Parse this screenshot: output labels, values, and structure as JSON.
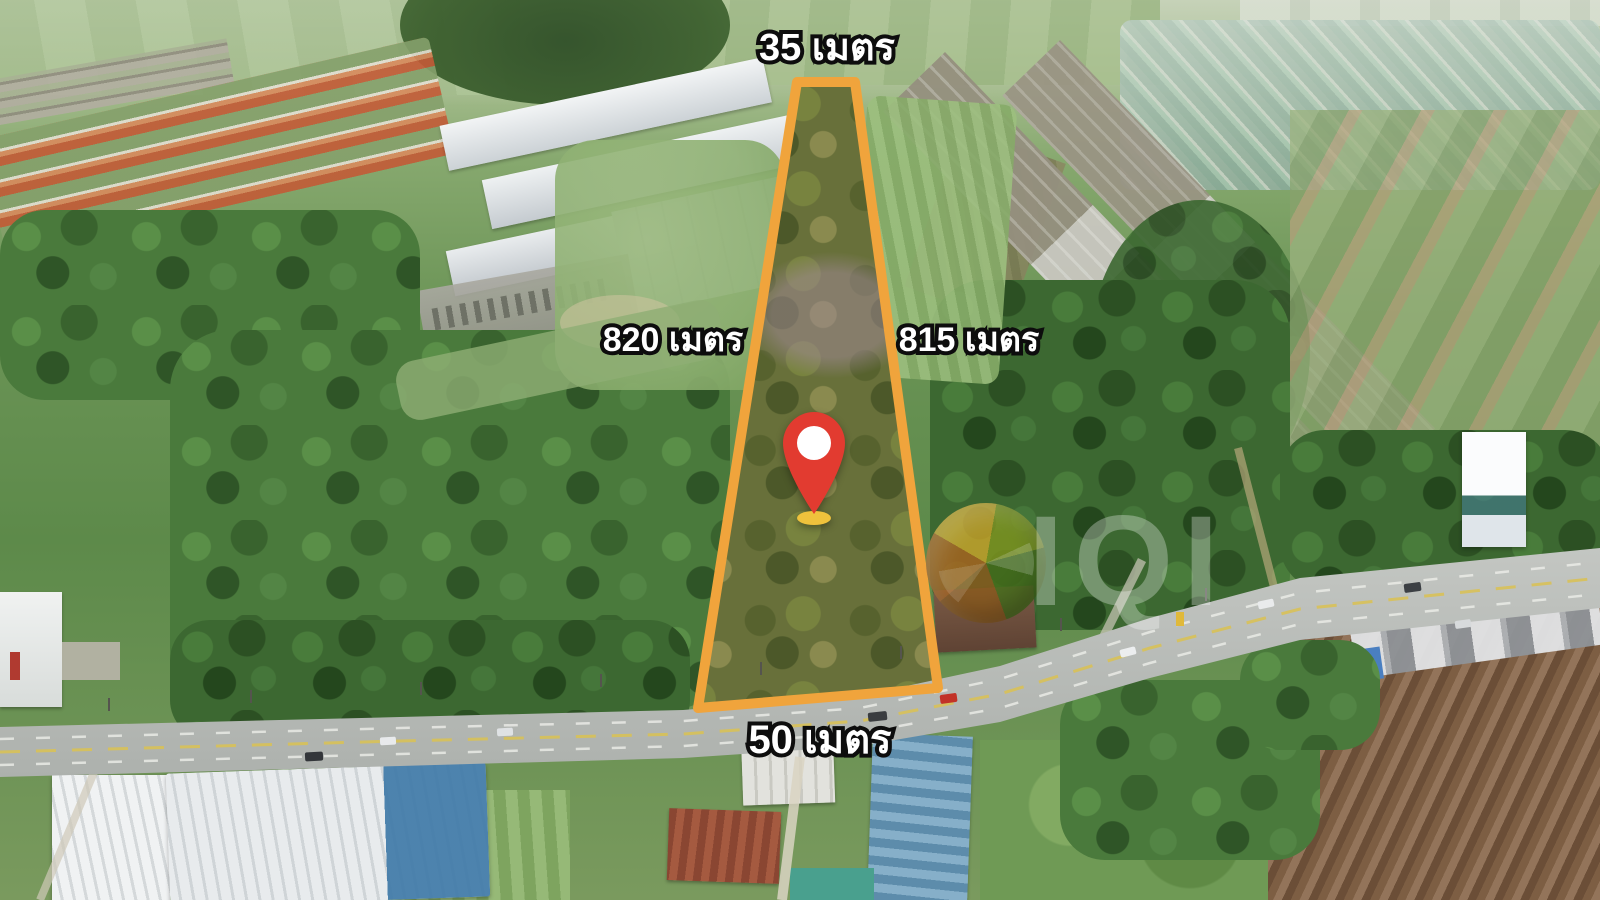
{
  "scene": {
    "type": "aerial-drone-photo",
    "description": "Aerial view of a roadside land plot outlined in orange for sale, surrounded by a factory, housing estates, fields and a main road"
  },
  "plot": {
    "boundary_color": "#F0A43C",
    "labels": {
      "top": "35 เมตร",
      "left": "820 เมตร",
      "right": "815 เมตร",
      "bottom": "50 เมตร"
    }
  },
  "pin": {
    "body_color": "#E23B30",
    "dot_color": "#FFFFFF",
    "base_color": "#EFC23C"
  },
  "watermark": {
    "letters": "IQI"
  }
}
